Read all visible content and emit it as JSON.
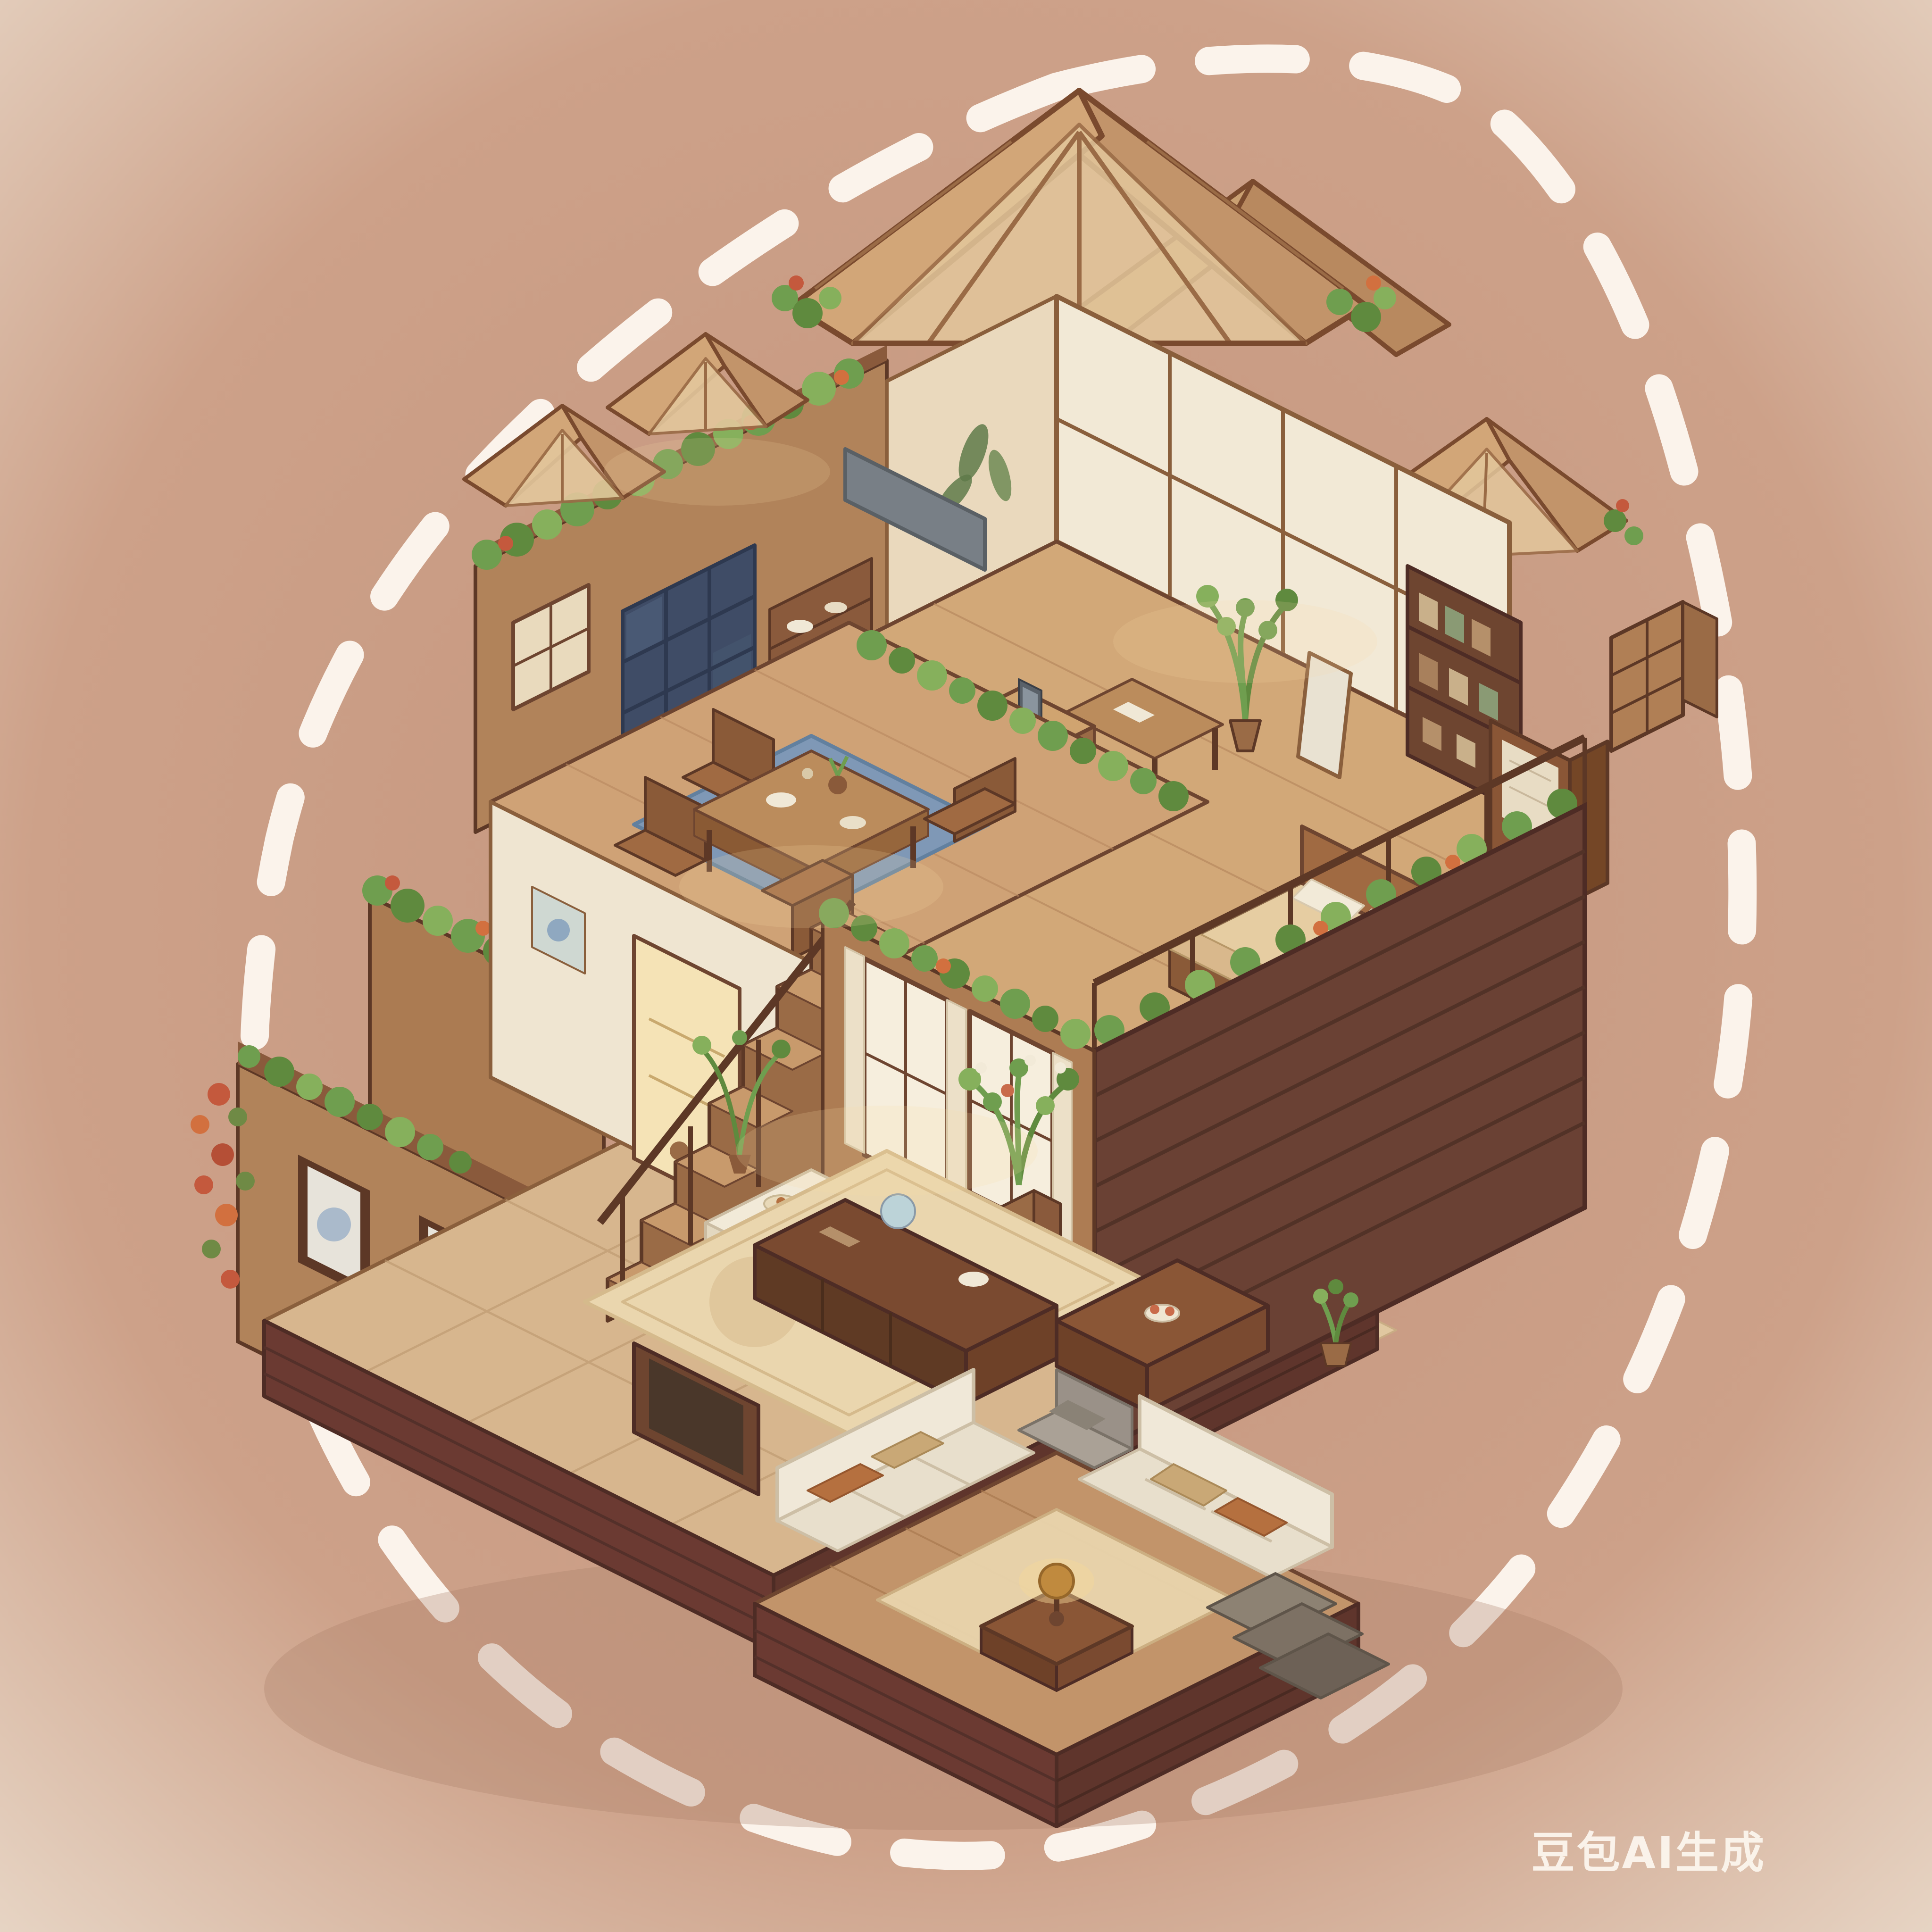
{
  "artwork": {
    "type": "isometric cutaway illustration",
    "subject": "cozy two-story wooden house interior with greenhouse skylight roofs and plants",
    "style": "warm watercolor storybook, sticker with dashed outline",
    "watermark": "豆包AI生成"
  },
  "palette": {
    "bg_center": "#c4957d",
    "bg_edge": "#ecdfd0",
    "dash": "#fcf6ee",
    "wood_light": "#d0a470",
    "wood_mid": "#a3744e",
    "wood_dark": "#6e4530",
    "outline": "#5d3826",
    "plinth": "#6b3a32",
    "facade_planks": "#6a4134",
    "stone_floor": "#d7b68e",
    "white_wall": "#f2e9d6",
    "glass_warm": "#e3c79c",
    "navy_cabinet": "#3f4c66",
    "rug_blue": "#7f98b6",
    "rug_cream": "#e9d5ad",
    "sofa_cream": "#f0e8d8",
    "foliage": "#6f9e4f",
    "foliage_dark": "#5f8a3e",
    "flowers": "#c4593d",
    "lamp_gold": "#c08a3e"
  },
  "scene": {
    "rooms": [
      "greenhouse glass gable roofs",
      "kitchen with navy cabinet and counter island",
      "dining area on blue rug",
      "study with shoji wall, bookshelf and potted plant",
      "bedroom with bed, wardrobe and plant-lined balcony",
      "tea room with clothed table and curtained windows",
      "living room with rug, media console and leaning frame",
      "sunken lounge with two cream sofas and gold lamp",
      "stair hall with display cabinet and framed pictures"
    ],
    "landscaping": "flower boxes and hedges along every wall top",
    "base": "dark maroon plank plinth with gray stone steps"
  }
}
